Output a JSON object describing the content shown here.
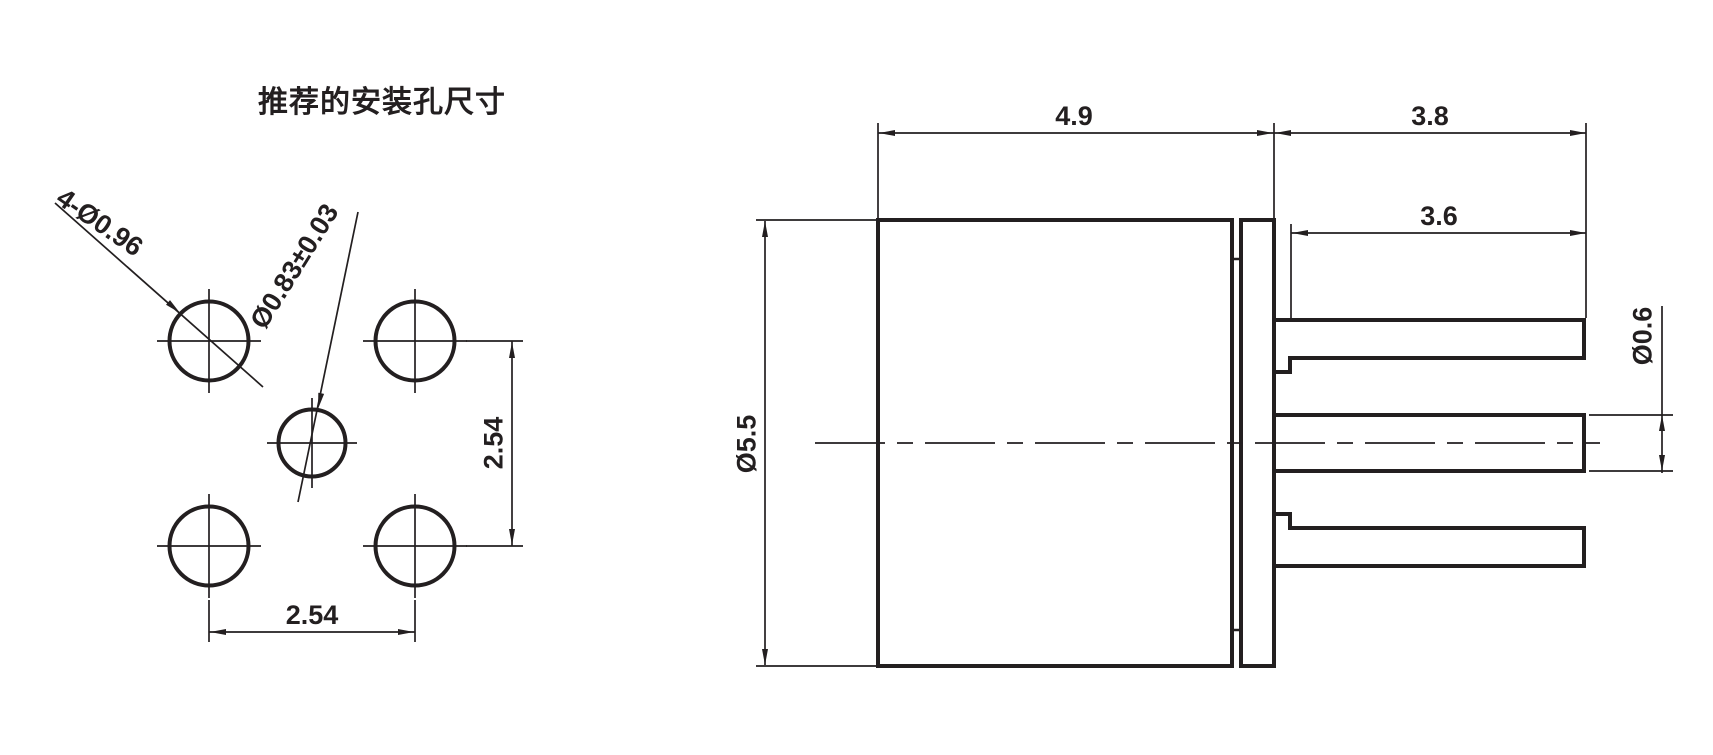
{
  "title": "推荐的安装孔尺寸",
  "colors": {
    "line": "#231f20",
    "background": "#ffffff"
  },
  "hole_view": {
    "labels": {
      "corner_holes": "4-Ø0.96",
      "center_hole": "Ø0.83±0.03",
      "vertical_pitch": "2.54",
      "horizontal_pitch": "2.54"
    }
  },
  "side_view": {
    "labels": {
      "body_length": "4.9",
      "pin_overall_length": "3.8",
      "pin_exposed_length": "3.6",
      "body_diameter": "Ø5.5",
      "pin_diameter": "Ø0.6"
    }
  }
}
